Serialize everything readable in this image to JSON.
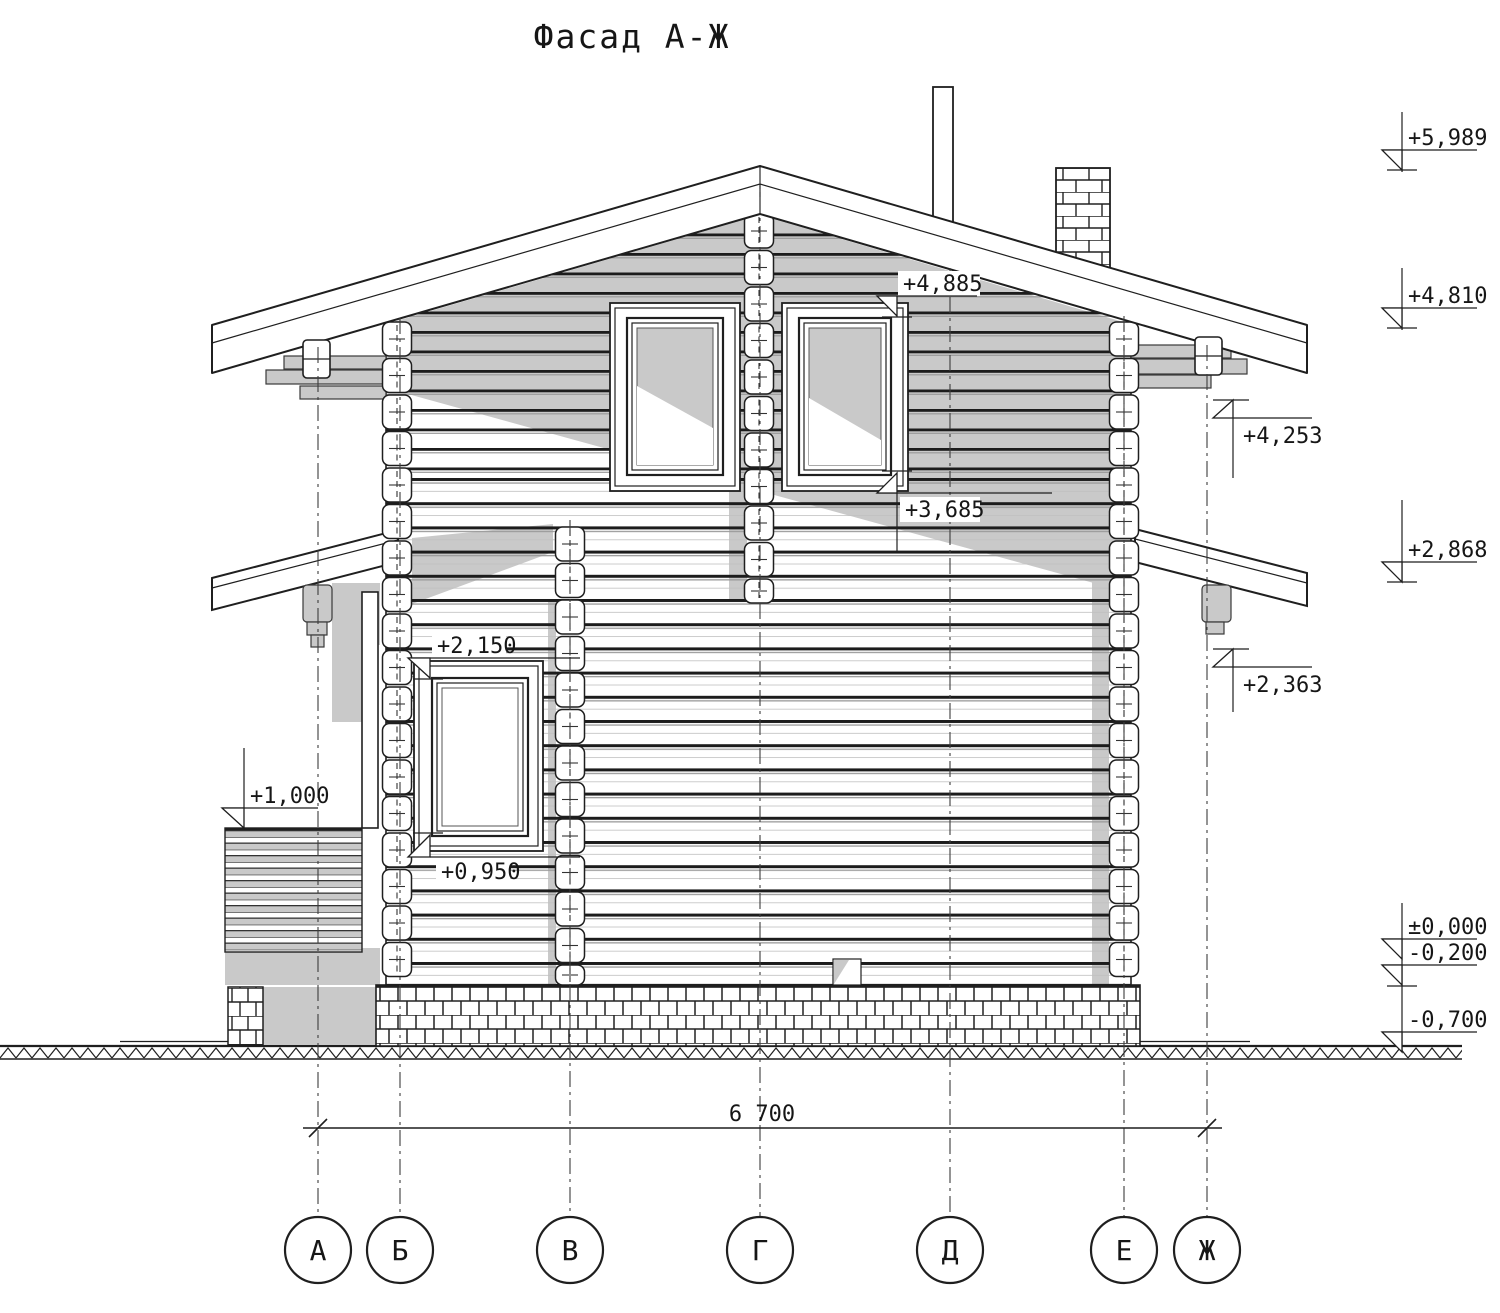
{
  "title": "Фасад А-Ж",
  "levels": {
    "ridge": {
      "text": "+5,989"
    },
    "eave": {
      "text": "+4,810"
    },
    "canopy": {
      "text": "+2,868"
    },
    "zero": {
      "text": "±0,000"
    },
    "minus200": {
      "text": "-0,200"
    },
    "minus700": {
      "text": "-0,700"
    },
    "wall_top": {
      "text": "+4,253"
    },
    "canopy_right": {
      "text": "+2,363"
    },
    "win2_head": {
      "text": "+4,885"
    },
    "win2_sill": {
      "text": "+3,685"
    },
    "win1_head": {
      "text": "+2,150"
    },
    "win1_sill": {
      "text": "+0,950"
    },
    "balcony": {
      "text": "+1,000"
    }
  },
  "dimensions": {
    "overall_width": "6 700"
  },
  "axes": {
    "labels": [
      "А",
      "Б",
      "В",
      "Г",
      "Д",
      "Е",
      "Ж"
    ]
  },
  "colors": {
    "line": "#1f1f1f",
    "shadow": "#c9c9c9",
    "paper": "#ffffff"
  }
}
